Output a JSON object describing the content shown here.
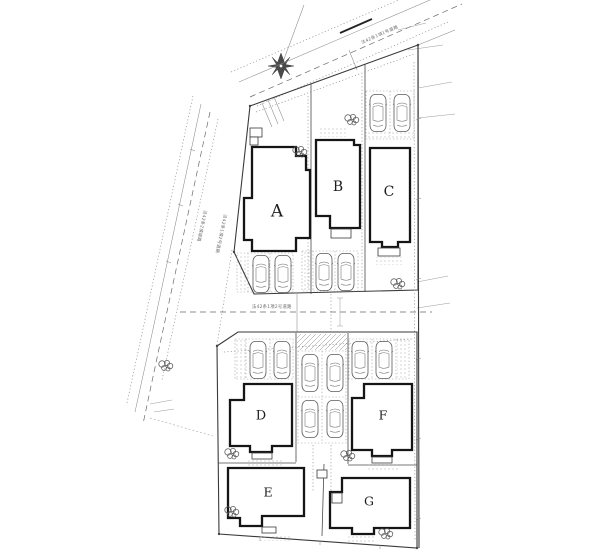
{
  "canvas": {
    "width": 600,
    "height": 560,
    "background": "#ffffff"
  },
  "colors": {
    "line": "#4a4a4a",
    "light_line": "#8a8a8a",
    "building_outline": "#151515",
    "label_text": "#1d1d1d"
  },
  "lots": [
    {
      "id": "A",
      "label": "A"
    },
    {
      "id": "B",
      "label": "B"
    },
    {
      "id": "C",
      "label": "C"
    },
    {
      "id": "D",
      "label": "D"
    },
    {
      "id": "E",
      "label": "E"
    },
    {
      "id": "F",
      "label": "F"
    },
    {
      "id": "G",
      "label": "G"
    }
  ],
  "roads": {
    "top": {
      "label": "法42条1項1号道路"
    },
    "left_outer": {
      "label": "法42条2項道路"
    },
    "left_inner": {
      "label": "法42条1項2号道路"
    },
    "middle": {
      "label": "法42条1項2号道路"
    }
  },
  "icons": {
    "north_arrow": "eight-point-star-compass",
    "car": "car-top-view",
    "tree": "tree-scribble"
  },
  "counts": {
    "buildings": 7,
    "cars": 14,
    "trees": 8
  }
}
